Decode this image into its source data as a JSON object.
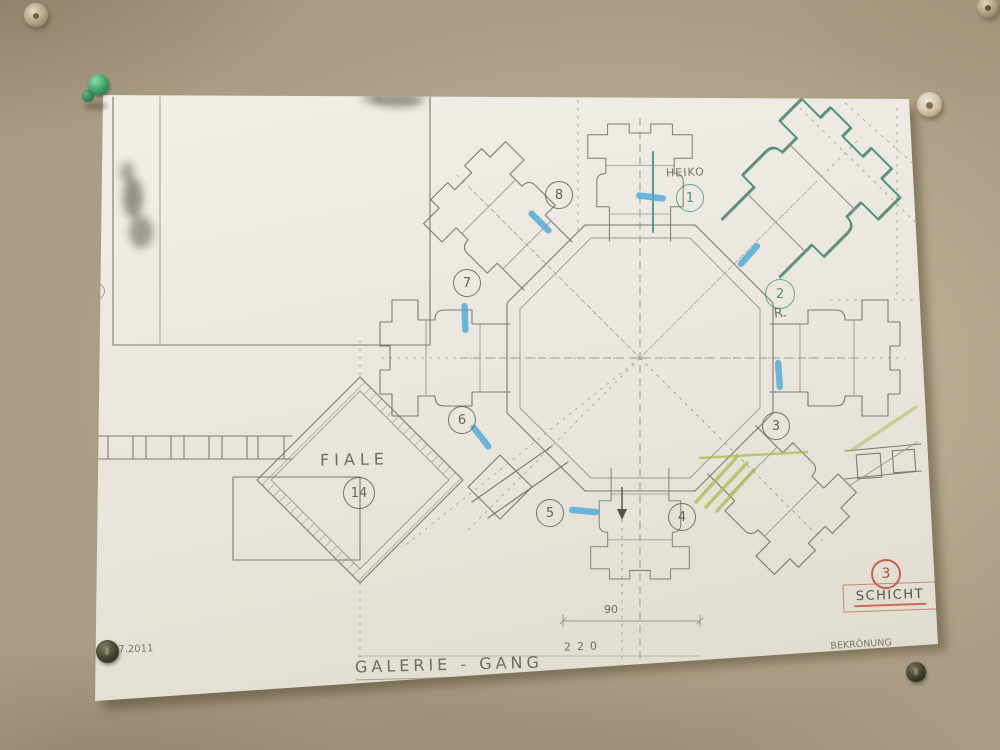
{
  "drawing": {
    "plan_labels": {
      "heiko": "HEIKO",
      "radius_note": "R.",
      "fiale": "FIALE",
      "galerie_gang": "GALERIE - GANG"
    },
    "markers": {
      "m1": "1",
      "m2": "2",
      "m3": "3",
      "m4": "4",
      "m5": "5",
      "m6": "6",
      "m7": "7",
      "m8": "8",
      "m14": "14"
    },
    "layer_stamp": {
      "number": "3",
      "label": "SCHICHT"
    },
    "dimensions": {
      "d90": "90",
      "d220": "220"
    },
    "title_block": {
      "line1": "BEKRÖNUNG",
      "line2": "TREPPENTURM - WEST",
      "line3": "RE. QUERSCHIFF - ANSI."
    },
    "date": "07.2011",
    "colors": {
      "pencil": "#78736a",
      "trace_teal": "#35917c",
      "highlight_blue": "#49a8d8",
      "highlight_green": "#a3bc4a",
      "stamp_red": "#bf4b38"
    }
  },
  "pins": {
    "wall_top_left": "metal-disc-pin",
    "wall_top_right": "metal-disc-pin",
    "paper_top_left": "green-pushpin",
    "paper_top_right": "beige-pin",
    "paper_bottom_left": "dark-pin",
    "paper_bottom_right": "dark-pin"
  }
}
